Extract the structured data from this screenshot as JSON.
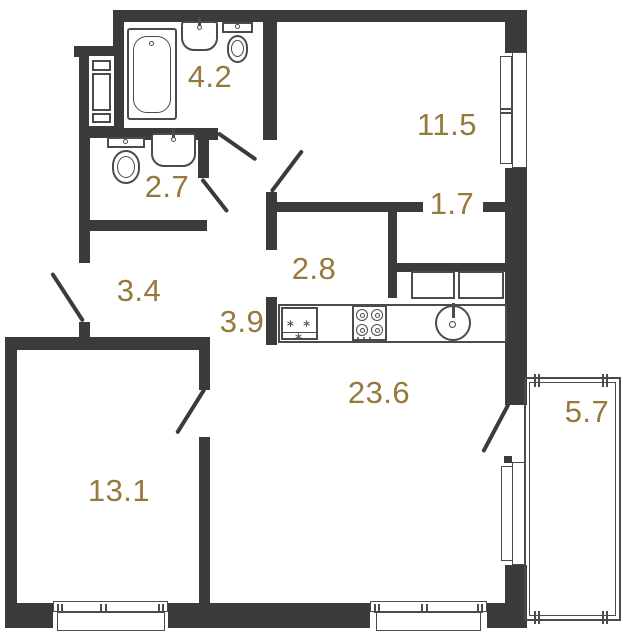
{
  "floorplan": {
    "title": "apartment-floor-plan",
    "colors": {
      "accent": "#97783d",
      "wall": "#3b3b3b",
      "line": "#4b4b4b",
      "background": "#ffffff"
    },
    "rooms": [
      {
        "id": "bathroom",
        "area": "4.2"
      },
      {
        "id": "bedroom",
        "area": "11.5"
      },
      {
        "id": "wc",
        "area": "2.7"
      },
      {
        "id": "wardrobe-niche",
        "area": "1.7"
      },
      {
        "id": "kitchen-niche",
        "area": "2.8"
      },
      {
        "id": "hallway",
        "area": "3.4"
      },
      {
        "id": "corridor",
        "area": "3.9"
      },
      {
        "id": "living-kitchen",
        "area": "23.6"
      },
      {
        "id": "bedroom-2",
        "area": "13.1"
      },
      {
        "id": "balcony",
        "area": "5.7"
      }
    ],
    "fixtures": {
      "fridge_symbol": "∗ ∗ ∗"
    }
  }
}
